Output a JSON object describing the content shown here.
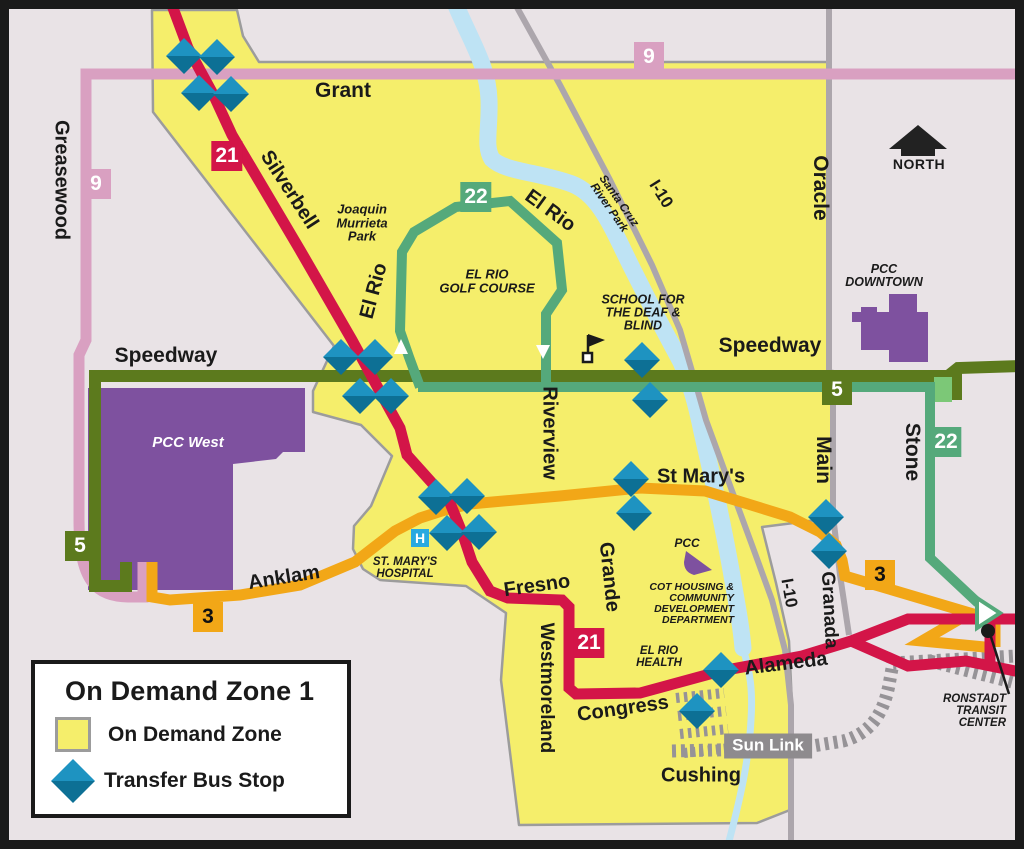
{
  "colors": {
    "background": "#E9E3E6",
    "frame": "#1A1A1A",
    "zone_fill": "#F5EE6B",
    "zone_border": "#9C9C9C",
    "route_9": "#D9A0C1",
    "route_21": "#D31548",
    "route_22": "#55A97B",
    "route_22_light": "#7CC877",
    "route_5": "#5C7A1D",
    "route_3": "#F2A717",
    "building": "#7E519F",
    "river": "#BEE3F4",
    "road": "#ACA6AC",
    "sunlink": "#969397",
    "stop_top": "#1E93C1",
    "stop_bottom": "#0D7095"
  },
  "legend": {
    "title": "On Demand Zone 1",
    "zone_label": "On Demand Zone",
    "stop_label": "Transfer Bus Stop"
  },
  "north": {
    "label": "NORTH"
  },
  "hospital_icon": "H",
  "sun_link": {
    "label": "Sun Link"
  },
  "ronstadt": {
    "label": "RONSTADT\nTRANSIT\nCENTER"
  },
  "badges": [
    {
      "route": "9",
      "x": 649,
      "y": 57,
      "fg": "#FFFFFF"
    },
    {
      "route": "9",
      "x": 96,
      "y": 184,
      "fg": "#FFFFFF"
    },
    {
      "route": "21",
      "x": 227,
      "y": 156,
      "fg": "#FFFFFF"
    },
    {
      "route": "21",
      "x": 589,
      "y": 643,
      "fg": "#FFFFFF"
    },
    {
      "route": "22",
      "x": 476,
      "y": 197,
      "fg": "#FFFFFF"
    },
    {
      "route": "22",
      "x": 946,
      "y": 442,
      "fg": "#FFFFFF"
    },
    {
      "route": "5",
      "x": 80,
      "y": 546,
      "fg": "#FFFFFF"
    },
    {
      "route": "5",
      "x": 837,
      "y": 390,
      "fg": "#FFFFFF"
    },
    {
      "route": "3",
      "x": 208,
      "y": 617,
      "fg": "#111111"
    },
    {
      "route": "3",
      "x": 880,
      "y": 575,
      "fg": "#111111"
    }
  ],
  "stops": [
    {
      "x": 184,
      "y": 56
    },
    {
      "x": 217,
      "y": 57
    },
    {
      "x": 199,
      "y": 93
    },
    {
      "x": 231,
      "y": 94
    },
    {
      "x": 341,
      "y": 357
    },
    {
      "x": 375,
      "y": 357
    },
    {
      "x": 360,
      "y": 396
    },
    {
      "x": 391,
      "y": 396
    },
    {
      "x": 642,
      "y": 360
    },
    {
      "x": 650,
      "y": 400
    },
    {
      "x": 436,
      "y": 497
    },
    {
      "x": 467,
      "y": 496
    },
    {
      "x": 447,
      "y": 533
    },
    {
      "x": 479,
      "y": 532
    },
    {
      "x": 631,
      "y": 479
    },
    {
      "x": 634,
      "y": 513
    },
    {
      "x": 826,
      "y": 517
    },
    {
      "x": 829,
      "y": 551
    },
    {
      "x": 721,
      "y": 670
    },
    {
      "x": 697,
      "y": 711
    }
  ],
  "labels": [
    {
      "id": "greasewood",
      "text": "Greasewood",
      "x": 61,
      "y": 180,
      "rot": 90,
      "size": 20
    },
    {
      "id": "grant",
      "text": "Grant",
      "x": 343,
      "y": 91,
      "rot": 0,
      "size": 21
    },
    {
      "id": "silverbell",
      "text": "Silverbell",
      "x": 289,
      "y": 190,
      "rot": 57,
      "size": 20
    },
    {
      "id": "el-rio-west",
      "text": "El Rio",
      "x": 374,
      "y": 291,
      "rot": -75,
      "size": 20
    },
    {
      "id": "el-rio-north",
      "text": "El Rio",
      "x": 550,
      "y": 211,
      "rot": 36,
      "size": 20
    },
    {
      "id": "speedway-west",
      "text": "Speedway",
      "x": 166,
      "y": 356,
      "rot": 0,
      "size": 21
    },
    {
      "id": "speedway-east",
      "text": "Speedway",
      "x": 770,
      "y": 346,
      "rot": 0,
      "size": 21
    },
    {
      "id": "riverview",
      "text": "Riverview",
      "x": 549,
      "y": 433,
      "rot": 90,
      "size": 20
    },
    {
      "id": "oracle",
      "text": "Oracle",
      "x": 820,
      "y": 188,
      "rot": 90,
      "size": 21
    },
    {
      "id": "i10-north",
      "text": "I-10",
      "x": 661,
      "y": 194,
      "rot": 58,
      "size": 17
    },
    {
      "id": "i10-south",
      "text": "I-10",
      "x": 789,
      "y": 593,
      "rot": 80,
      "size": 17
    },
    {
      "id": "main",
      "text": "Main",
      "x": 823,
      "y": 460,
      "rot": 90,
      "size": 21
    },
    {
      "id": "stone",
      "text": "Stone",
      "x": 912,
      "y": 452,
      "rot": 90,
      "size": 21
    },
    {
      "id": "st-marys",
      "text": "St Mary's",
      "x": 701,
      "y": 477,
      "rot": 0,
      "size": 20
    },
    {
      "id": "grande",
      "text": "Grande",
      "x": 609,
      "y": 577,
      "rot": 84,
      "size": 20
    },
    {
      "id": "fresno",
      "text": "Fresno",
      "x": 537,
      "y": 586,
      "rot": -8,
      "size": 20
    },
    {
      "id": "anklam",
      "text": "Anklam",
      "x": 284,
      "y": 578,
      "rot": -9,
      "size": 20
    },
    {
      "id": "westmoreland",
      "text": "Westmoreland",
      "x": 546,
      "y": 688,
      "rot": 90,
      "size": 19
    },
    {
      "id": "congress",
      "text": "Congress",
      "x": 623,
      "y": 709,
      "rot": -8,
      "size": 20
    },
    {
      "id": "alameda",
      "text": "Alameda",
      "x": 786,
      "y": 664,
      "rot": -7,
      "size": 20
    },
    {
      "id": "granada",
      "text": "Granada",
      "x": 829,
      "y": 610,
      "rot": 87,
      "size": 19
    },
    {
      "id": "cushing",
      "text": "Cushing",
      "x": 701,
      "y": 776,
      "rot": 0,
      "size": 20
    },
    {
      "id": "joaquin-murrieta-park",
      "text": "Joaquin\nMurrieta\nPark",
      "x": 362,
      "y": 223,
      "rot": 0,
      "size": 13,
      "italic": true
    },
    {
      "id": "el-rio-golf-course",
      "text": "EL RIO\nGOLF COURSE",
      "x": 487,
      "y": 281,
      "rot": 0,
      "size": 13,
      "italic": true
    },
    {
      "id": "school-deaf-blind",
      "text": "SCHOOL FOR\nTHE DEAF &\nBLIND",
      "x": 643,
      "y": 313,
      "rot": 0,
      "size": 12.5,
      "italic": true
    },
    {
      "id": "santa-cruz-river-park",
      "text": "Santa Cruz\nRiver Park",
      "x": 613,
      "y": 205,
      "rot": 55,
      "size": 11.5,
      "italic": true
    },
    {
      "id": "pcc-downtown",
      "text": "PCC\nDOWNTOWN",
      "x": 884,
      "y": 276,
      "rot": 0,
      "size": 12.5,
      "italic": true
    },
    {
      "id": "pcc-west",
      "text": "PCC West",
      "x": 188,
      "y": 443,
      "rot": 0,
      "size": 15,
      "italic": true,
      "color": "#FFFFFF"
    },
    {
      "id": "st-marys-hospital",
      "text": "ST. MARY'S\nHOSPITAL",
      "x": 405,
      "y": 569,
      "rot": 0,
      "size": 11.5,
      "italic": true
    },
    {
      "id": "pcc-cot",
      "text": "PCC",
      "x": 687,
      "y": 543,
      "rot": 0,
      "size": 12,
      "italic": true
    },
    {
      "id": "cot-housing",
      "text": "COT HOUSING &\nCOMMUNITY\nDEVELOPMENT\nDEPARTMENT",
      "x": 734,
      "y": 604,
      "rot": 0,
      "size": 10.5,
      "italic": true,
      "align": "right"
    },
    {
      "id": "el-rio-health",
      "text": "EL RIO\nHEALTH",
      "x": 659,
      "y": 658,
      "rot": 0,
      "size": 11.5,
      "italic": true
    },
    {
      "id": "ronstadt-transit-center",
      "text": "RONSTADT\nTRANSIT\nCENTER",
      "x": 1006,
      "y": 712,
      "rot": 0,
      "size": 11.5,
      "italic": true,
      "align": "right"
    }
  ]
}
